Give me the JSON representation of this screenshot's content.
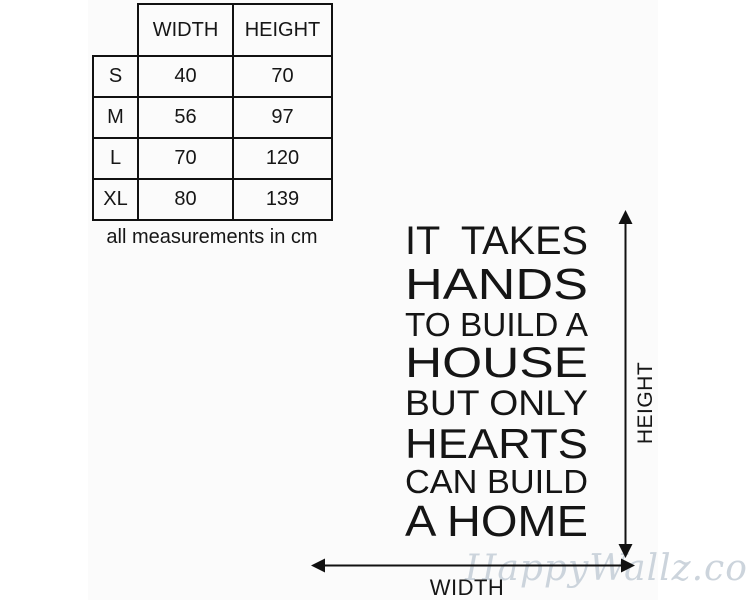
{
  "size_table": {
    "col_headers": [
      "WIDTH",
      "HEIGHT"
    ],
    "rows": [
      {
        "label": "S",
        "width": "40",
        "height": "70"
      },
      {
        "label": "M",
        "width": "56",
        "height": "97"
      },
      {
        "label": "L",
        "width": "70",
        "height": "120"
      },
      {
        "label": "XL",
        "width": "80",
        "height": "139"
      }
    ],
    "caption": "all measurements in cm"
  },
  "decal_quote": {
    "lines": [
      "IT  TAKES",
      "HANDS",
      "TO BUILD A",
      "HOUSE",
      "BUT ONLY",
      "HEARTS",
      "CAN BUILD",
      "A HOME"
    ]
  },
  "dimension_arrows": {
    "height_label": "HEIGHT",
    "width_label": "WIDTH"
  },
  "watermark": {
    "text": "HappyWallz.com.au",
    "color": "#ccd4dc"
  },
  "colors": {
    "ink": "#161616",
    "table_border": "#111111",
    "background": "#ffffff",
    "photo_background": "#fbfbfb"
  }
}
